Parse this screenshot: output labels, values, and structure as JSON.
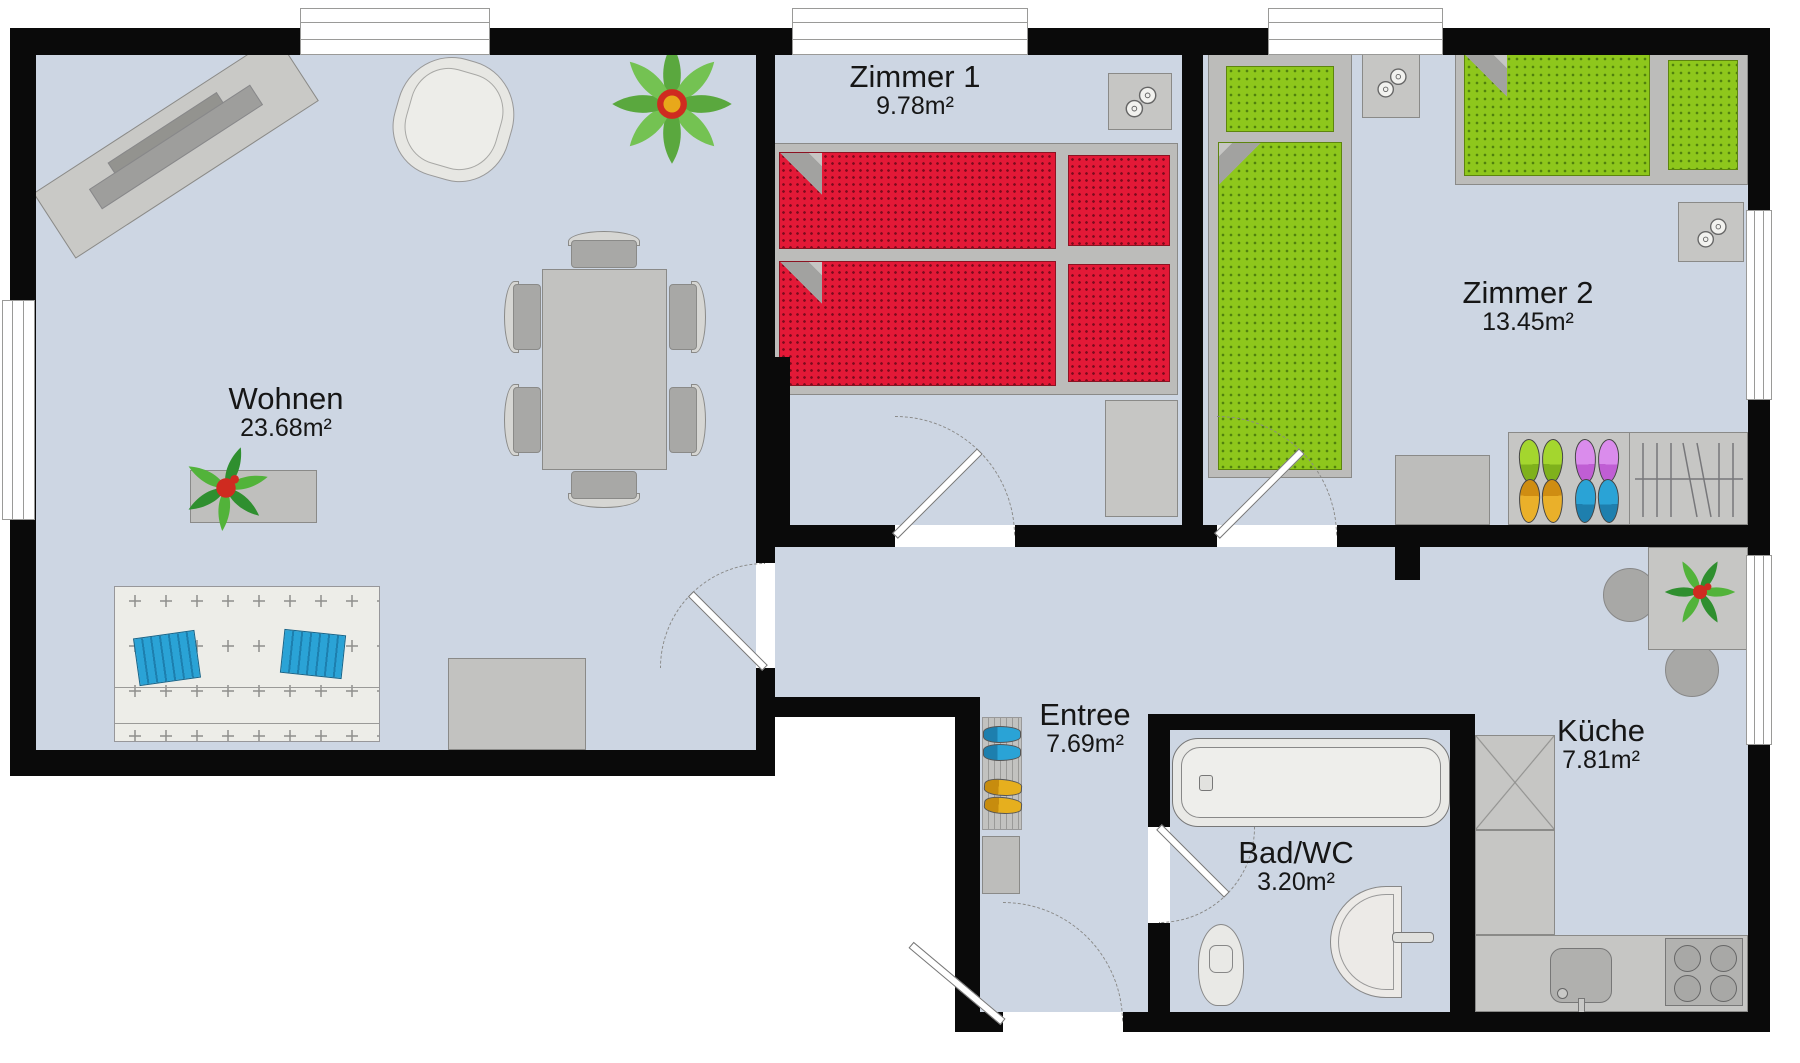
{
  "page_title": "Apartment floor plan",
  "rooms": [
    {
      "name": "Wohnen",
      "area": "23.68m²"
    },
    {
      "name": "Zimmer 1",
      "area": "9.78m²"
    },
    {
      "name": "Zimmer 2",
      "area": "13.45m²"
    },
    {
      "name": "Entree",
      "area": "7.69m²"
    },
    {
      "name": "Bad/WC",
      "area": "3.20m²"
    },
    {
      "name": "Küche",
      "area": "7.81m²"
    }
  ],
  "palette": {
    "floor": "#cdd6e3",
    "wall": "#0a0a0a",
    "furniture_gray": "#c6c6c4",
    "mattress_red": "#e31937",
    "mattress_green": "#8ec71c",
    "cushion_blue": "#2aa3d6",
    "shoe_green": "#a4d62e",
    "shoe_purple": "#da8cec",
    "shoe_orange": "#eab02a",
    "shoe_blue": "#2aa3d6",
    "plant_green": "#55b33a",
    "flower_red": "#cf2b20",
    "flower_yellow": "#e8a81a"
  },
  "icons": {
    "lamp": "lamp-icon (two overlapping circles on nightstands)",
    "door": "door-swing-icon (leaf with dashed quarter arc)",
    "window": "window-icon (white break in wall with frame lines)",
    "hangers": "clothes-rail-icon (vertical hanger lines with rod)"
  }
}
